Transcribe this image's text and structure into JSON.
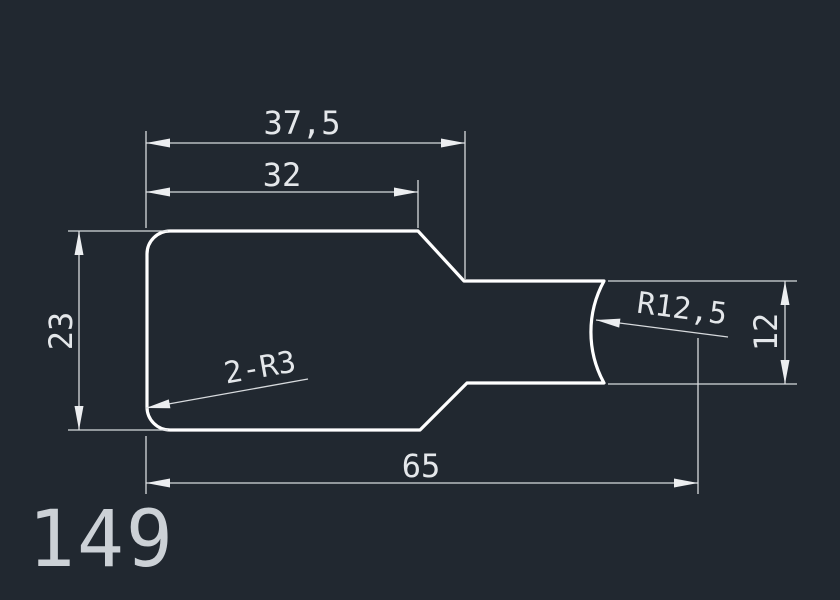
{
  "canvas": {
    "background_color": "#212830",
    "outline_color": "#ffffff",
    "dimension_color": "#d7dadd",
    "text_color": "#e4e7ea"
  },
  "drawing": {
    "part_number": "149",
    "dimensions": {
      "top_overall_width": "37,5",
      "top_inner_width": "32",
      "left_height": "23",
      "bottom_length": "65",
      "right_neck_height": "12",
      "fillet_note": "2-R3",
      "end_arc_radius": "R12,5"
    }
  }
}
